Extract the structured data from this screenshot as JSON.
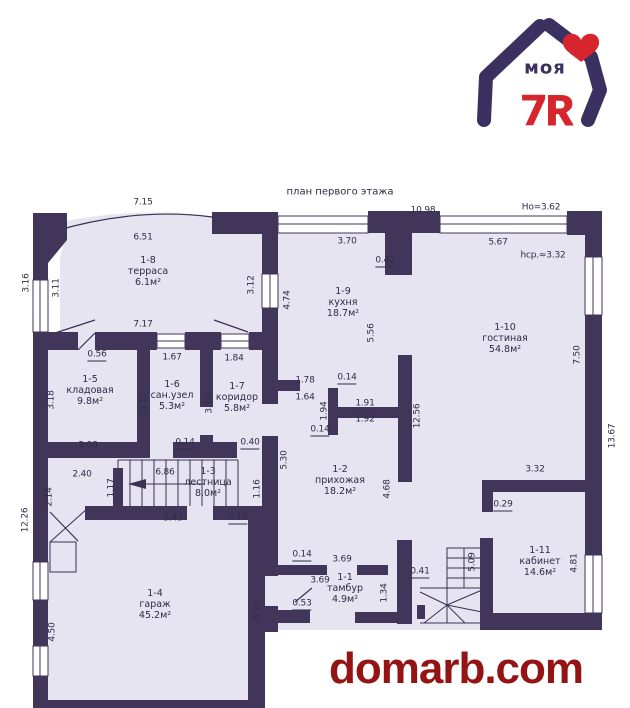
{
  "title": "план первого этажа",
  "watermark": "domarb.com",
  "logo": {
    "word": "моя",
    "number": "7",
    "letter": "Я"
  },
  "colors": {
    "wall": "#413659",
    "floor": "#e7e4f1",
    "logo_navy": "#3b3160",
    "logo_red": "#d6252d",
    "watermark_red": "#941414"
  },
  "rooms": [
    {
      "id": "1-8",
      "name": "терраса",
      "area": "6.1м²",
      "x": 148,
      "y": 260
    },
    {
      "id": "1-9",
      "name": "кухня",
      "area": "18.7м²",
      "x": 343,
      "y": 291
    },
    {
      "id": "1-10",
      "name": "гостиная",
      "area": "54.8м²",
      "x": 505,
      "y": 327
    },
    {
      "id": "1-5",
      "name": "кладовая",
      "area": "9.8м²",
      "x": 90,
      "y": 379
    },
    {
      "id": "1-6",
      "name": "сан.узел",
      "area": "5.3м²",
      "x": 172,
      "y": 384
    },
    {
      "id": "1-7",
      "name": "коридор",
      "area": "5.8м²",
      "x": 237,
      "y": 386
    },
    {
      "id": "1-3",
      "name": "лестница",
      "area": "8.0м²",
      "x": 208,
      "y": 471
    },
    {
      "id": "1-2",
      "name": "прихожая",
      "area": "18.2м²",
      "x": 340,
      "y": 469
    },
    {
      "id": "1-1",
      "name": "тамбур",
      "area": "4.9м²",
      "x": 345,
      "y": 577
    },
    {
      "id": "1-4",
      "name": "гараж",
      "area": "45.2м²",
      "x": 155,
      "y": 593
    },
    {
      "id": "1-11",
      "name": "кабинет",
      "area": "14.6м²",
      "x": 540,
      "y": 550
    }
  ],
  "dimensions": [
    {
      "t": "7.15",
      "x": 143,
      "y": 203
    },
    {
      "t": "10.98",
      "x": 423,
      "y": 211
    },
    {
      "t": "Но=3.62",
      "x": 541,
      "y": 208
    },
    {
      "t": "6.51",
      "x": 143,
      "y": 238
    },
    {
      "t": "3.70",
      "x": 347,
      "y": 242
    },
    {
      "t": "5.67",
      "x": 498,
      "y": 243
    },
    {
      "t": "hср.≈3.32",
      "x": 543,
      "y": 256
    },
    {
      "t": "0.42",
      "x": 385,
      "y": 262,
      "u": 1
    },
    {
      "t": "3.16",
      "x": 27,
      "y": 283,
      "r": 1
    },
    {
      "t": "3.11",
      "x": 57,
      "y": 288,
      "r": 1
    },
    {
      "t": "3.12",
      "x": 252,
      "y": 285,
      "r": 1
    },
    {
      "t": "4.74",
      "x": 288,
      "y": 300,
      "r": 1
    },
    {
      "t": "7.17",
      "x": 143,
      "y": 325
    },
    {
      "t": "5.56",
      "x": 372,
      "y": 333,
      "r": 1
    },
    {
      "t": "7.50",
      "x": 578,
      "y": 355,
      "r": 1
    },
    {
      "t": "13.67",
      "x": 613,
      "y": 436,
      "r": 1
    },
    {
      "t": "0.56",
      "x": 97,
      "y": 356,
      "u": 1
    },
    {
      "t": "1.67",
      "x": 172,
      "y": 358
    },
    {
      "t": "1.84",
      "x": 234,
      "y": 359
    },
    {
      "t": "3.18",
      "x": 52,
      "y": 400,
      "r": 1
    },
    {
      "t": "3.17",
      "x": 145,
      "y": 402,
      "r": 1
    },
    {
      "t": "3.16",
      "x": 210,
      "y": 404,
      "r": 1
    },
    {
      "t": "1.78",
      "x": 305,
      "y": 381
    },
    {
      "t": "0.14",
      "x": 347,
      "y": 379,
      "u": 1
    },
    {
      "t": "1.64",
      "x": 305,
      "y": 398
    },
    {
      "t": "1.94",
      "x": 325,
      "y": 411,
      "r": 1
    },
    {
      "t": "1.91",
      "x": 365,
      "y": 404
    },
    {
      "t": "1.92",
      "x": 365,
      "y": 420
    },
    {
      "t": "0.14",
      "x": 320,
      "y": 431,
      "u": 1
    },
    {
      "t": "12.56",
      "x": 418,
      "y": 416,
      "r": 1
    },
    {
      "t": "3.08",
      "x": 88,
      "y": 446
    },
    {
      "t": "0.14",
      "x": 185,
      "y": 444,
      "u": 1
    },
    {
      "t": "0.40",
      "x": 250,
      "y": 444,
      "u": 1
    },
    {
      "t": "5.30",
      "x": 285,
      "y": 460,
      "r": 1
    },
    {
      "t": "2.40",
      "x": 82,
      "y": 475
    },
    {
      "t": "6.86",
      "x": 165,
      "y": 473
    },
    {
      "t": "1.17",
      "x": 112,
      "y": 488,
      "r": 1
    },
    {
      "t": "2.14",
      "x": 50,
      "y": 497,
      "r": 1
    },
    {
      "t": "12.26",
      "x": 26,
      "y": 520,
      "r": 1
    },
    {
      "t": "1.16",
      "x": 258,
      "y": 489,
      "r": 1
    },
    {
      "t": "5.43",
      "x": 173,
      "y": 519
    },
    {
      "t": "0.15",
      "x": 238,
      "y": 519,
      "u": 1
    },
    {
      "t": "4.68",
      "x": 388,
      "y": 489,
      "r": 1
    },
    {
      "t": "3.32",
      "x": 535,
      "y": 470
    },
    {
      "t": "0.29",
      "x": 503,
      "y": 506,
      "u": 1
    },
    {
      "t": "0.14",
      "x": 302,
      "y": 556,
      "u": 1
    },
    {
      "t": "3.69",
      "x": 342,
      "y": 560
    },
    {
      "t": "0.41",
      "x": 420,
      "y": 573,
      "u": 1
    },
    {
      "t": "3.69",
      "x": 320,
      "y": 581
    },
    {
      "t": "1.34",
      "x": 385,
      "y": 593,
      "r": 1
    },
    {
      "t": "5.09",
      "x": 473,
      "y": 562,
      "r": 1
    },
    {
      "t": "0.53",
      "x": 302,
      "y": 605,
      "u": 1
    },
    {
      "t": "4.50",
      "x": 53,
      "y": 632,
      "r": 1
    },
    {
      "t": "6.22",
      "x": 258,
      "y": 610,
      "r": 1
    },
    {
      "t": "4.81",
      "x": 575,
      "y": 563,
      "r": 1
    }
  ]
}
